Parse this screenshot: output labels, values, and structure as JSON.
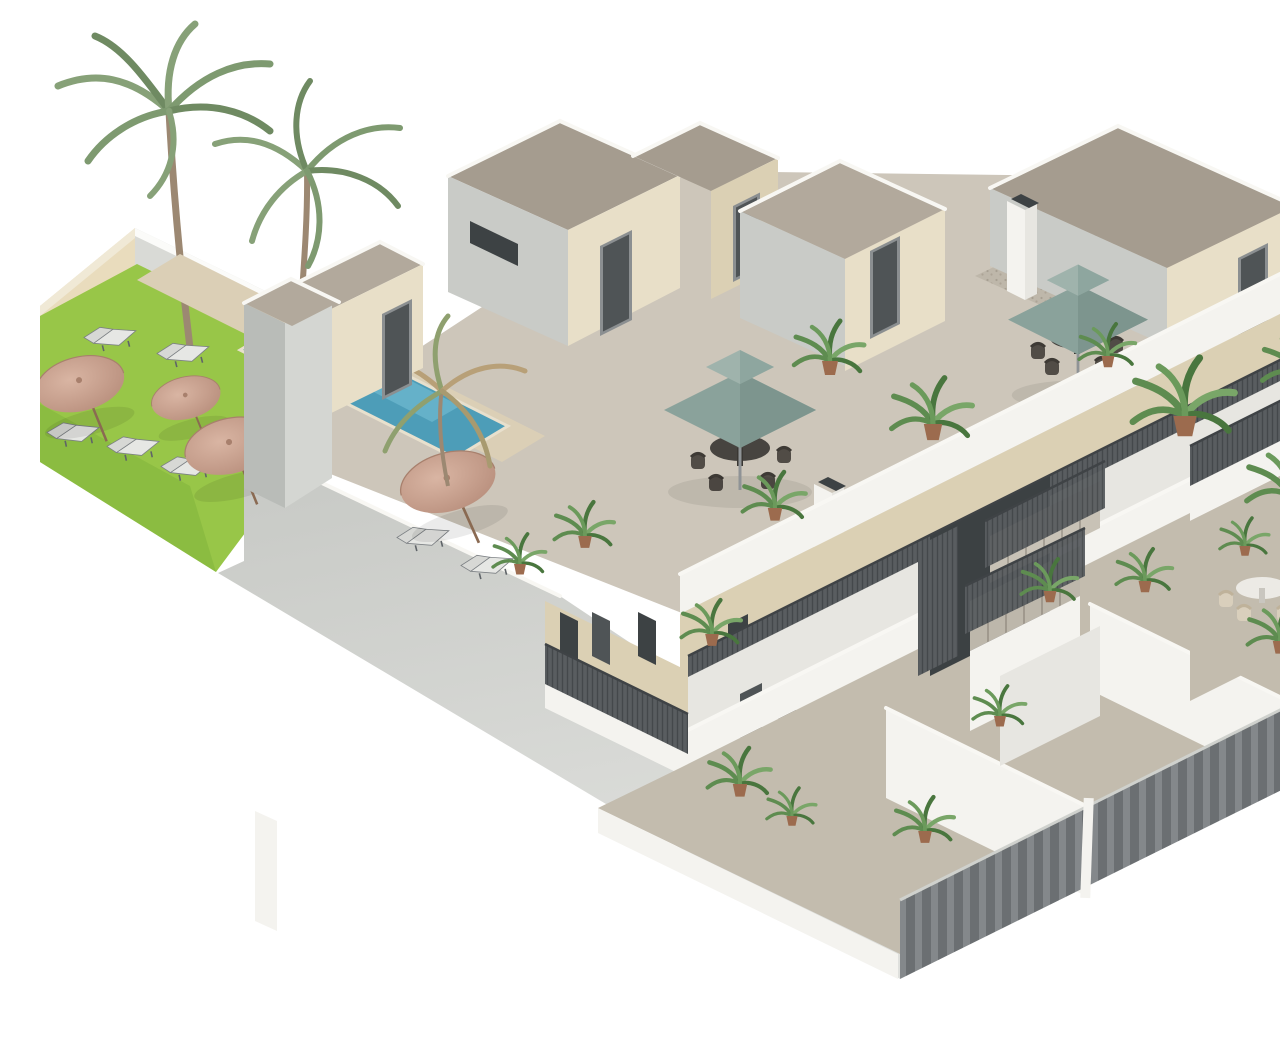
{
  "meta": {
    "title": "3D isometric cutaway rendering of a two-storey apartment complex with roof terraces, communal garden and swimming pool",
    "type": "architectural-3d-render",
    "view": "aerial isometric cutaway",
    "background": "#ffffff"
  },
  "palette": {
    "lawn": "#98c648",
    "lawn_shadow": "#82b43c",
    "pool_water": "#4d9db8",
    "pool_light": "#7ec6d9",
    "pool_dark": "#2f7f9e",
    "path": "#dbcfb6",
    "garden_wall": "#e9dcbd",
    "back_wall": "#d9dad6",
    "big_wall": "#cbcdc9",
    "big_wall_fade": "#dddedb",
    "stucco": "#e8dfc8",
    "roof_taupe": "#b2a99c",
    "floor_taupe": "#cdc6ba",
    "gravel": "#beb7aa",
    "white_wall": "#f4f3ef",
    "door_dark": "#4f5456",
    "railing_dark": "#595d60",
    "fence_gray": "#84888b",
    "sage_umbrella": "#8aa29b",
    "sage_umbrella_dark": "#7d958e",
    "sage_umbrella_light": "#9fb3ac",
    "tan_umbrella": "#c9a08e",
    "tan_umbrella_dark": "#b78d7b",
    "plant_green": "#5e8c50",
    "plant_dark": "#49763e",
    "palm_green": "#87a178",
    "palm_dark": "#6f8a62",
    "trunk_brown": "#9c8872",
    "table_dark": "#474440",
    "chair_dark": "#514c46",
    "chair_cream": "#d9cfbc",
    "white_table": "#eceae5",
    "pot_terracotta": "#9c6b4e"
  },
  "scene": {
    "garden": {
      "label": "communal garden with pool",
      "palm_trees_tall": 2,
      "palm_trees_small": 1,
      "parasols_tan": 4,
      "sun_loungers": 7,
      "pool_count": 1,
      "boundary_walls": [
        "beige perimeter wall",
        "light gray rear wall"
      ]
    },
    "building": {
      "label": "two-storey apartment block, cutaway view",
      "levels": [
        "ground-floor terraces",
        "first-floor balcony walkway",
        "roof terraces"
      ],
      "roof": {
        "stair_bulkheads": 5,
        "sage_umbrellas": 2,
        "dining_sets": 2,
        "chimneys": 3,
        "gravel_patches": 1
      },
      "circulation": {
        "central_staircase": true,
        "railing_style": "dark metal mesh",
        "fence_style": "gray vertical slats"
      },
      "terrace_furniture": {
        "round_white_table": 1,
        "cream_chairs": 4,
        "potted_plants": 18
      }
    }
  }
}
